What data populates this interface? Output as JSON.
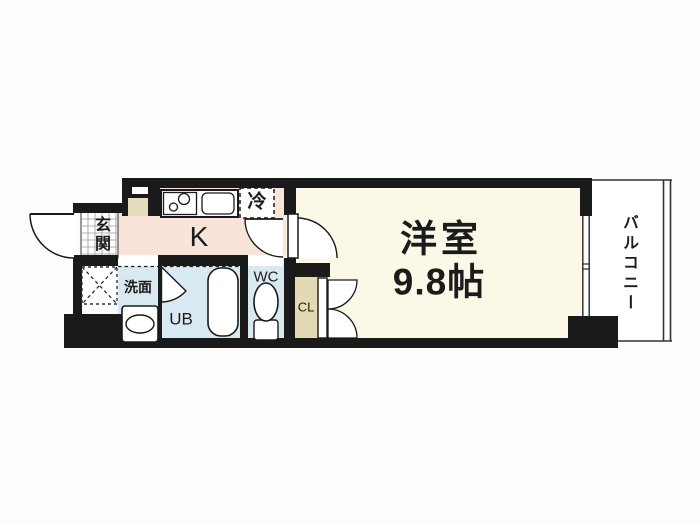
{
  "floorplan": {
    "rooms": {
      "genkan": {
        "label": "玄関"
      },
      "kitchen": {
        "label": "K"
      },
      "refrigerator": {
        "label": "冷"
      },
      "washroom": {
        "label": "洗面"
      },
      "unit_bath": {
        "label": "UB"
      },
      "toilet": {
        "label": "WC"
      },
      "closet": {
        "label": "CL"
      },
      "main_room": {
        "label": "洋室",
        "size": "9.8帖"
      },
      "balcony": {
        "label": "バルコニー"
      }
    },
    "colors": {
      "wall": "#1a1a1a",
      "kitchen_floor": "#f8e4d8",
      "main_room_floor": "#fbf8e7",
      "wet_area_floor": "#d9e9f1",
      "closet_floor": "#e3d9b3",
      "cabinet": "#e6ddbd",
      "balcony_floor": "#ffffff"
    }
  }
}
